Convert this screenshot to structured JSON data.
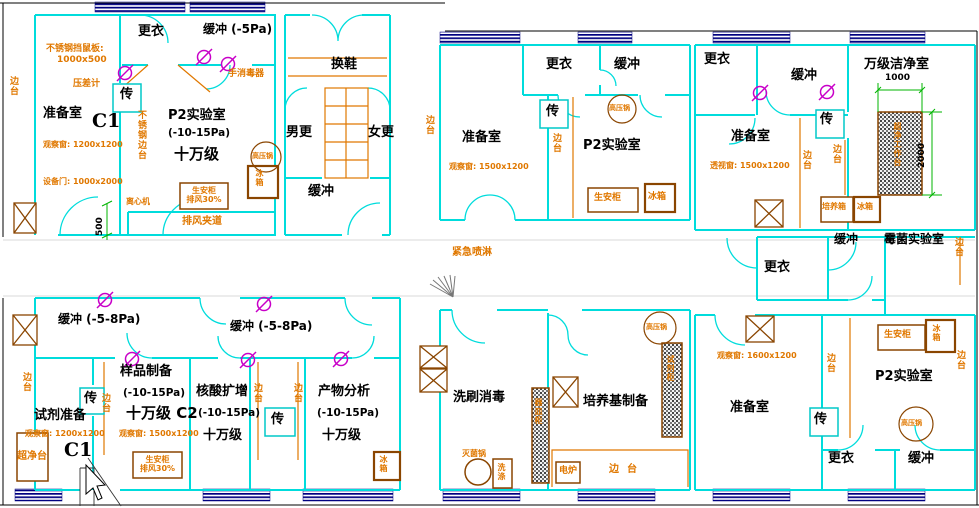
{
  "common": {
    "dressing": "更衣",
    "buffer": "缓冲",
    "buffer_5pa": "缓冲 (-5Pa)",
    "buffer_5_8pa": "缓冲 (-5-8Pa)",
    "pass_box": "传",
    "side_bench": "边台",
    "prep_room": "准备室",
    "p2_lab": "P2实验室",
    "pressure_range": "(-10-15Pa)",
    "class_100k": "十万级",
    "biosafety_cabinet": "生安柜",
    "exhaust_30": "排风30%",
    "fridge": "冰箱",
    "autoclave": "高压锅",
    "incubator": "培养箱"
  },
  "suite_top_left": {
    "rodent_board": "不锈钢挡鼠板:",
    "rodent_board_size": "1000x500",
    "pressure_gauge": "压差计",
    "room_code": "C1",
    "obs_window": "观察窗: 1200x1200",
    "equipment_door": "设备门: 1000x2000",
    "hand_sanitizer": "手消毒器",
    "ss_side_bench": "不锈钢边台",
    "centrifuge": "离心机",
    "exhaust_duct": "排风夹道",
    "dim_500": "500"
  },
  "suite_changing": {
    "shoe_change": "换鞋",
    "men_change": "男更",
    "women_change": "女更"
  },
  "suite_top_mid": {
    "obs_window": "观察窗: 1500x1200"
  },
  "suite_top_right": {
    "clean_room_10k": "万级洁净室",
    "view_window": "透视窗: 1500x1200",
    "clean_workbench": "超净工作台",
    "dim_1000": "1000",
    "dim_2000": "2000",
    "mold_lab": "霉菌实验室"
  },
  "corridor": {
    "emergency_shower": "紧急喷淋"
  },
  "suite_bottom_left": {
    "reagent_prep": "试剂准备",
    "room_code": "C1",
    "obs_window_small": "观察窗: 1200x1200",
    "clean_bench": "超净台",
    "sample_prep": "样品制备",
    "class_100k_c2": "十万级 C2",
    "obs_window_mid": "观察窗: 1500x1200",
    "pcr_amplification": "核酸扩增",
    "product_analysis": "产物分析"
  },
  "suite_bottom_mid": {
    "wash_disinfect": "洗刷消毒",
    "vessel_cabinet": "器皿柜",
    "sterilizer_pot": "灭菌锅",
    "wash_sink": "洗涤",
    "medium_prep": "培养基制备",
    "reagent_cabinet": "试剂柜",
    "electric_stove": "电炉"
  },
  "suite_bottom_right": {
    "obs_window": "观察窗: 1600x1200"
  }
}
